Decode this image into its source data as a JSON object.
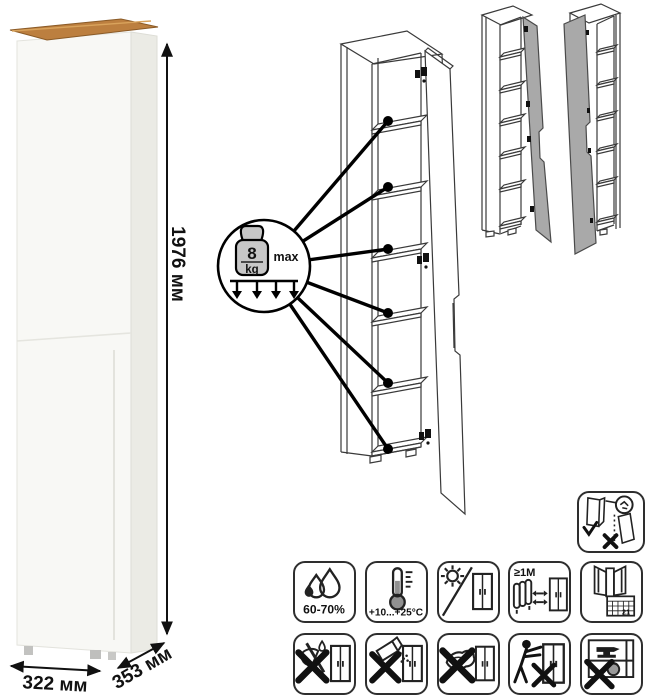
{
  "product": {
    "dimensions": {
      "height": "1976 мм",
      "width": "322 мм",
      "depth": "353 мм"
    }
  },
  "shelf_load": {
    "value": "8",
    "unit": "kg",
    "qualifier": "max"
  },
  "care": {
    "humidity": "60-70%",
    "temperature": "+10...+25°C",
    "min_distance": "≥1М",
    "calendar_day": "21"
  },
  "colors": {
    "wood_top": "#bc7f3f",
    "door_gray": "#a9a9a9",
    "ink": "#111111"
  }
}
